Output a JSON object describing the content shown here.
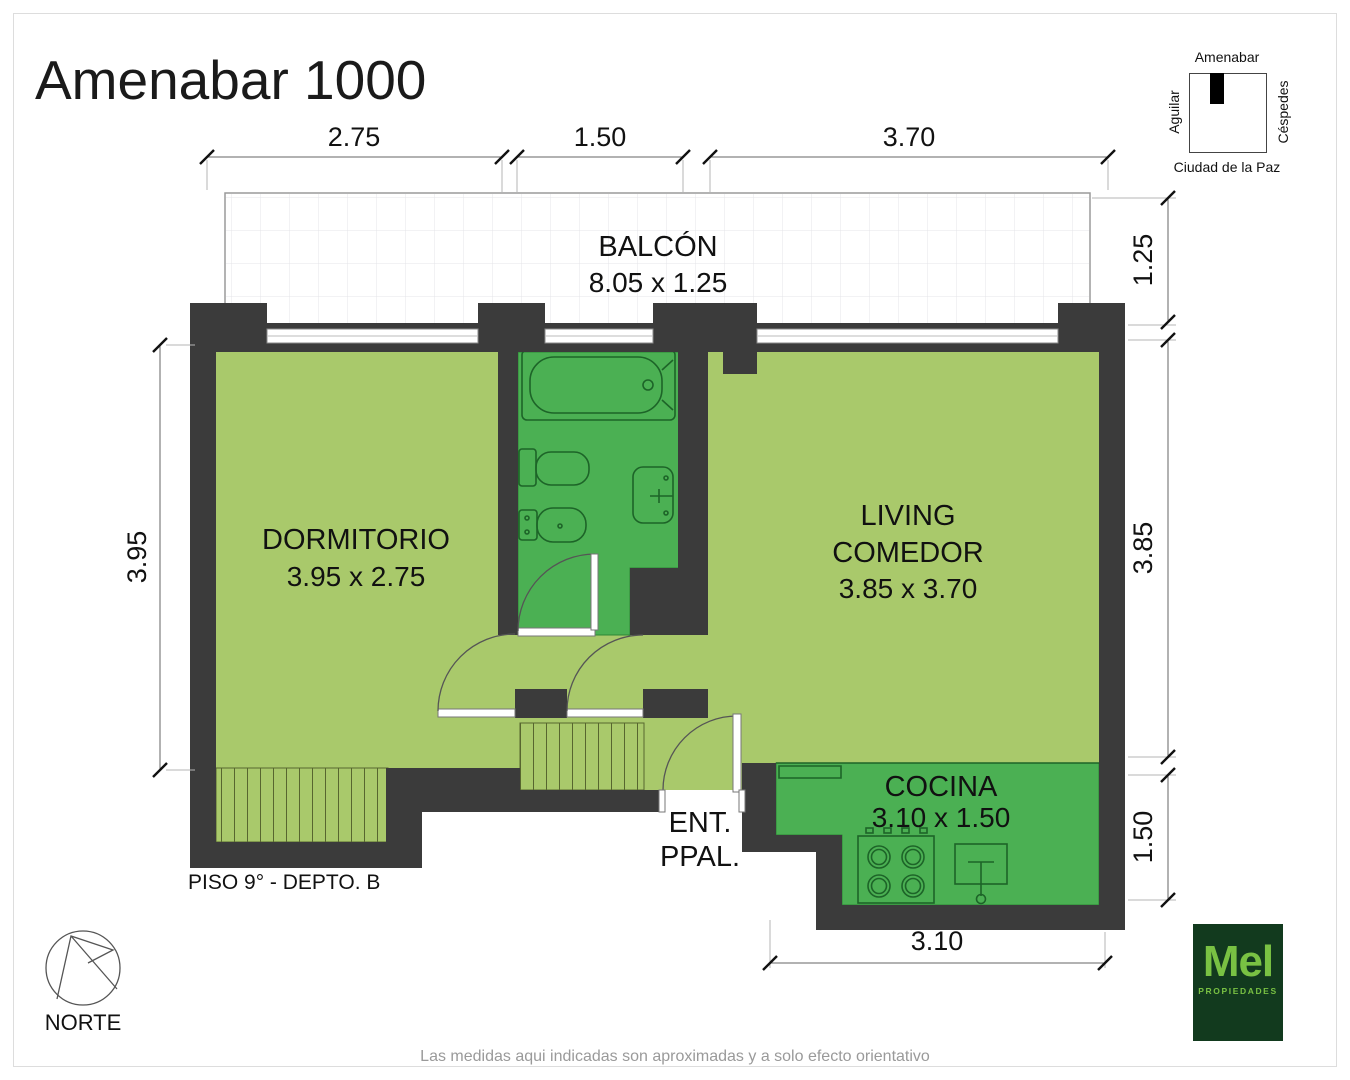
{
  "title": "Amenabar 1000",
  "locator": {
    "top": "Amenabar",
    "left": "Aguilar",
    "right": "Céspedes",
    "bottom": "Ciudad de la Paz"
  },
  "rooms": {
    "balcony": {
      "name": "BALCÓN",
      "size": "8.05 x 1.25"
    },
    "bedroom": {
      "name": "DORMITORIO",
      "size": "3.95 x 2.75"
    },
    "living": {
      "line1": "LIVING",
      "line2": "COMEDOR",
      "size": "3.85 x 3.70"
    },
    "kitchen": {
      "name": "COCINA",
      "size": "3.10 x 1.50"
    },
    "entry": {
      "line1": "ENT.",
      "line2": "PPAL."
    }
  },
  "dims": {
    "top": [
      "2.75",
      "1.50",
      "3.70"
    ],
    "right": [
      "1.25",
      "3.85",
      "1.50"
    ],
    "left": [
      "3.95"
    ],
    "bottom": [
      "3.10"
    ]
  },
  "floor_label": "PISO 9° - DEPTO. B",
  "compass_label": "NORTE",
  "logo": {
    "name": "Mel",
    "subtitle": "PROPIEDADES"
  },
  "footer": "Las medidas aqui indicadas son aproximadas y a solo efecto orientativo",
  "colors": {
    "floor": "#a9c96b",
    "wet": "#4bb053",
    "wall": "#3b3b3b",
    "logo_bg": "#123a1e",
    "logo_text": "#79c143"
  }
}
